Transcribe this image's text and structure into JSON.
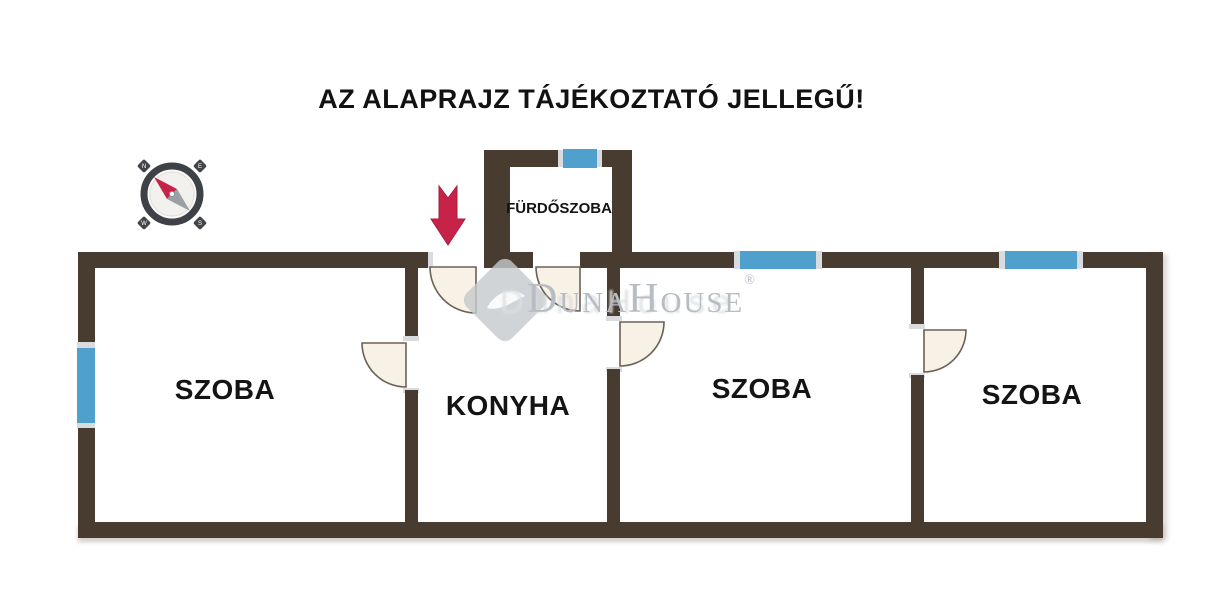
{
  "disclaimer": "AZ ALAPRAJZ TÁJÉKOZTATÓ JELLEGŰ!",
  "rooms": [
    {
      "label": "SZOBA"
    },
    {
      "label": "KONYHA"
    },
    {
      "label": "SZOBA"
    },
    {
      "label": "SZOBA"
    },
    {
      "label": "FÜRDŐSZOBA"
    }
  ],
  "watermark": {
    "brand": "DunaHouse",
    "registered": "®"
  },
  "compass": {
    "n": "N",
    "e": "E",
    "s": "S",
    "w": "W"
  },
  "icons": [
    "compass-icon",
    "entrance-arrow-icon",
    "door-arc-symbol",
    "window-symbol",
    "brand-diamond-logo"
  ],
  "colors": {
    "wall": "#483C31",
    "window": "#4FA0CC",
    "door_fill": "#F8F1E6",
    "arrow": "#C72348",
    "watermark_text": "#B7BDC3",
    "title_text": "#121212"
  }
}
